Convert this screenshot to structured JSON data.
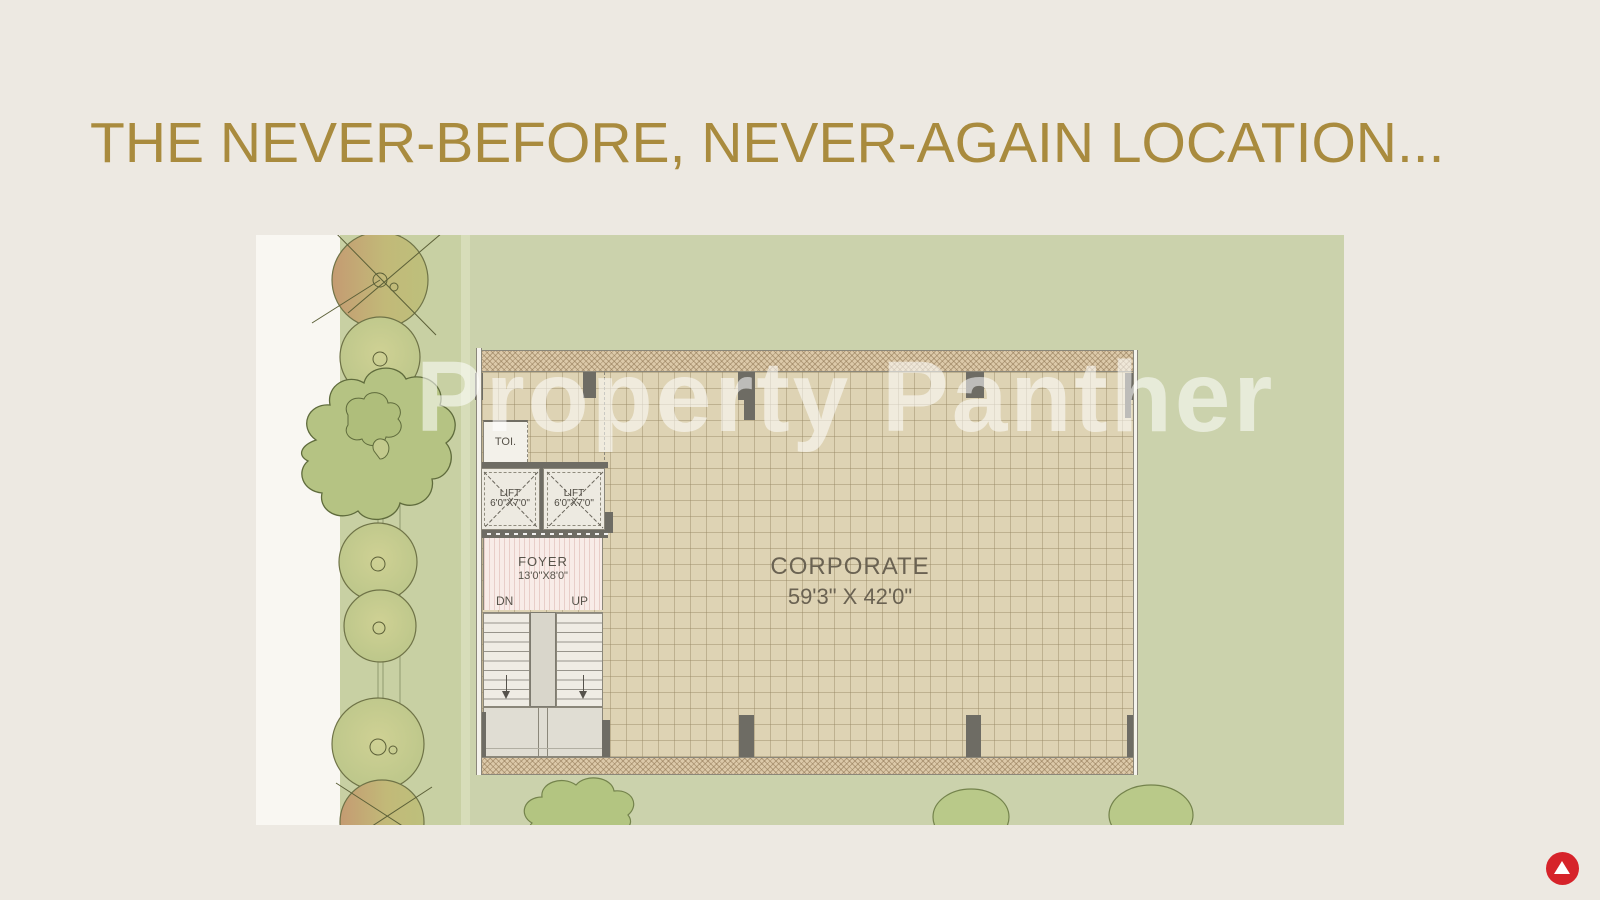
{
  "title": "THE NEVER-BEFORE, NEVER-AGAIN LOCATION...",
  "watermark": "Property Panther",
  "plan": {
    "corporate": {
      "label": "CORPORATE",
      "dims": "59'3\" X 42'0\""
    },
    "foyer": {
      "label": "FOYER",
      "dims": "13'0\"X8'0\""
    },
    "lifts": [
      {
        "label": "LIFT",
        "dims": "6'0\"X7'0\""
      },
      {
        "label": "LIFT",
        "dims": "6'0\"X7'0\""
      }
    ],
    "toilet": {
      "label": "TOI."
    },
    "stairs": {
      "down": "DN",
      "up": "UP"
    }
  },
  "colors": {
    "background": "#EDE9E2",
    "title_gold": "#A98B3E",
    "plan_green": "#CBD2AC",
    "logo_red": "#D6232A"
  }
}
